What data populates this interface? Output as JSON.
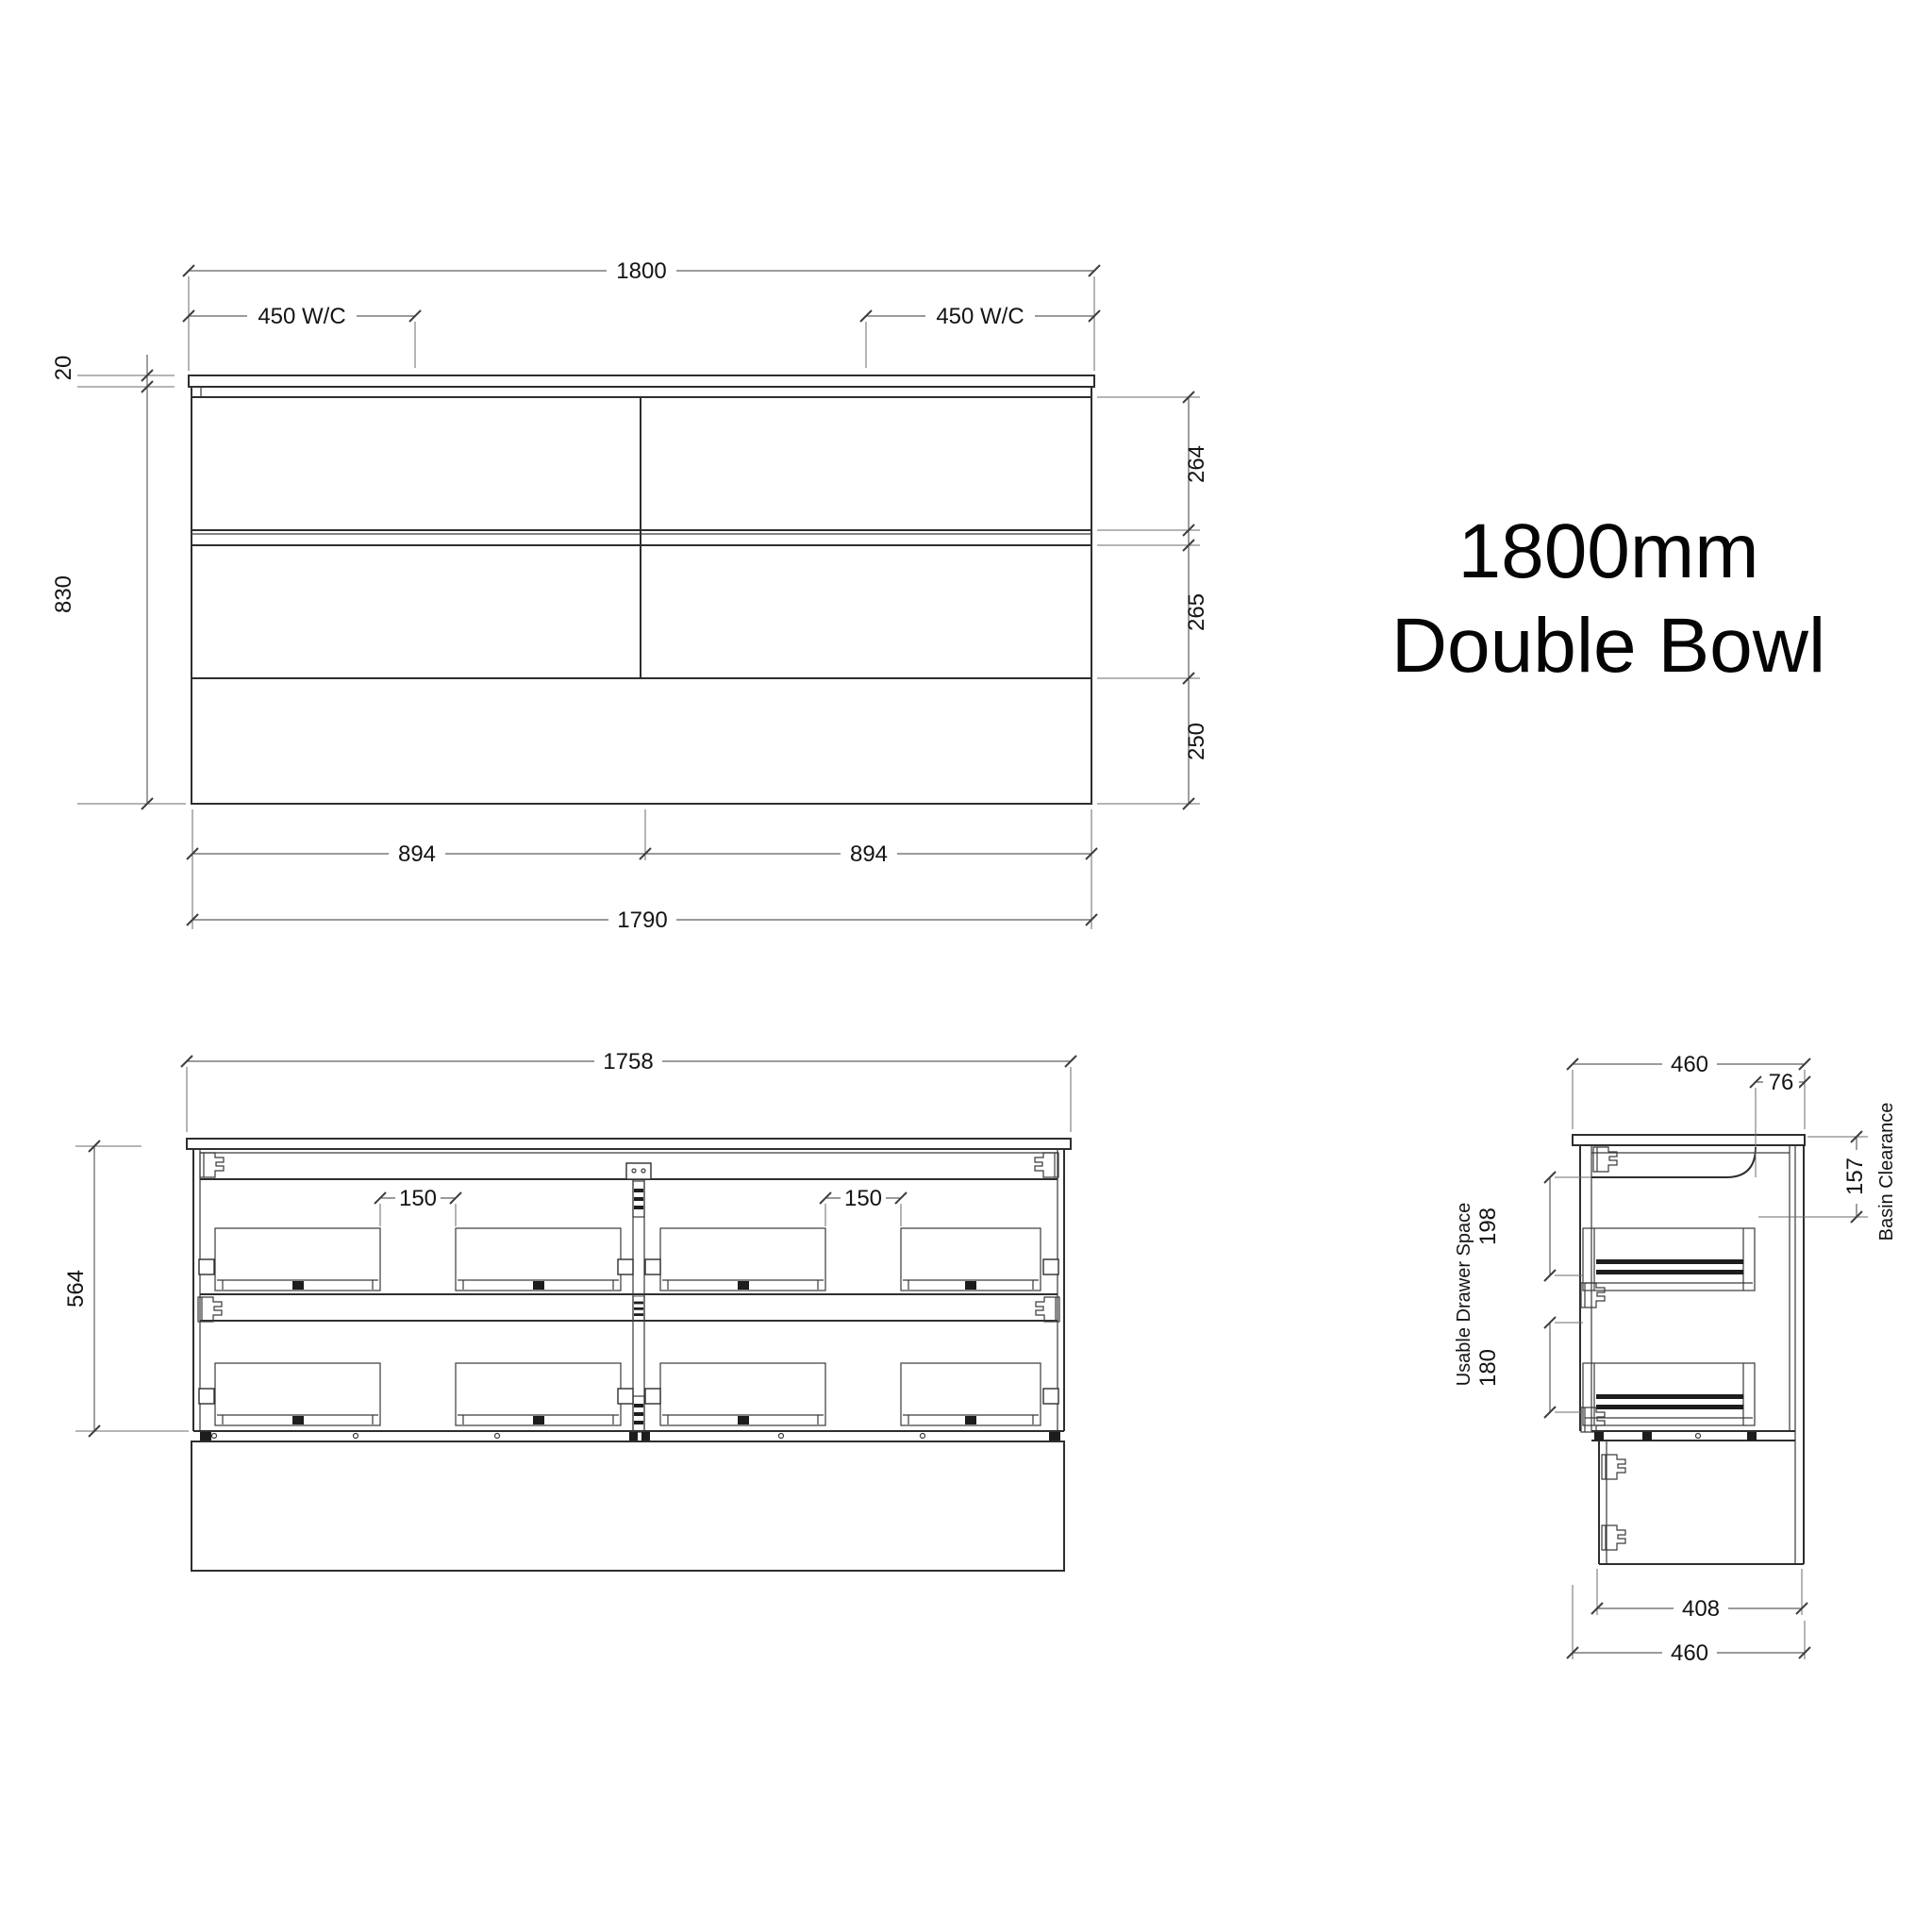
{
  "title": {
    "line1": "1800mm",
    "line2": "Double Bowl"
  },
  "front_view": {
    "dims": {
      "overall_width": "1800",
      "wc_left": "450 W/C",
      "wc_right": "450 W/C",
      "counter_thickness": "20",
      "overall_height": "830",
      "top_drawer_height": "264",
      "middle_drawer_height": "265",
      "bottom_panel_height": "250",
      "half_width_left": "894",
      "half_width_right": "894",
      "carcass_width": "1790"
    }
  },
  "internal_view": {
    "dims": {
      "carcass_width": "1758",
      "carcass_height": "564",
      "pipe_gap_left": "150",
      "pipe_gap_right": "150"
    }
  },
  "side_view": {
    "dims": {
      "depth": "460",
      "front_overhang": "76",
      "basin_clearance": "157",
      "basin_clearance_label": "Basin Clearance",
      "usable_label": "Usable Drawer Space",
      "top_drawer_space": "198",
      "bottom_drawer_space": "180",
      "kick_depth": "408",
      "bottom_depth": "460"
    }
  }
}
